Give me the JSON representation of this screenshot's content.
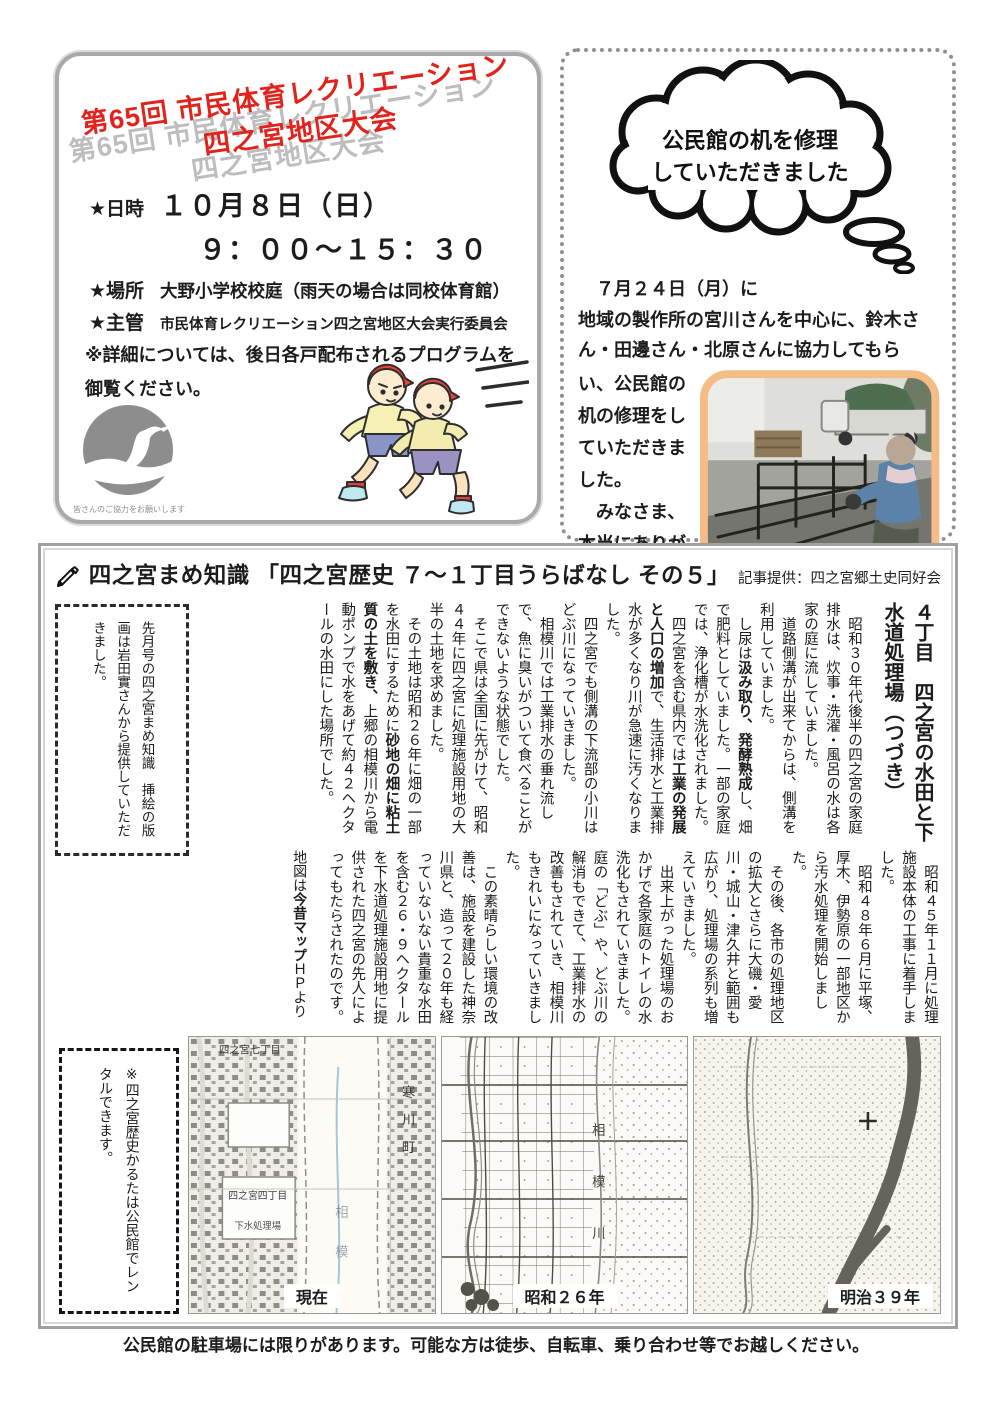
{
  "page": {
    "footer_notice": "公民館の駐車場には限りがあります。可能な方は徒歩、自転車、乗り合わせ等でお越しください。"
  },
  "event_box": {
    "title_line1": "第65回 市民体育レクリエーション",
    "title_line2": "四之宮地区大会",
    "datetime_label": "★日時",
    "date_value": "１０月８日（日）",
    "time_value": "９：００～１５：３０",
    "place_label": "★場所",
    "place_value": "大野小学校校庭（雨天の場合は同校体育館）",
    "organizer_label": "★主管",
    "organizer_value": "市民体育レクリエーション四之宮地区大会実行委員会",
    "note": "※詳細については、後日各戸配布されるプログラムを御覧ください。",
    "logo_caption": "皆さんのご協力をお願いします"
  },
  "repair_box": {
    "bubble_line1": "公民館の机を修理",
    "bubble_line2": "していただきました",
    "body_line1": "　７月２４日（月）に",
    "body_line2": "地域の製作所の宮川さんを中心に、鈴木さん・田邊さん・北原さんに協力してもら",
    "body_cont": "い、公民館の机の修理をしていただきました。",
    "body_thanks": "　みなさま、本当にありがとうございました。"
  },
  "article": {
    "header_title": "四之宮まめ知識 「四之宮歴史 ７～１丁目うらばなし その５」",
    "header_credit": "記事提供：四之宮郷土史同好会",
    "side_note": "先月号の四之宮まめ知識　挿絵の版画は岩田實さんから提供していただきました。",
    "heading": "４丁目　四之宮の水田と下水道処理場（つづき）",
    "upper_paragraphs": [
      "　昭和３０年代後半の四之宮の家庭排水は、炊事・洗濯・風呂の水は各家の庭に流していました。",
      "　道路側溝が出来てからは、側溝を利用していました。",
      "　し尿は汲み取り、発酵熟成し、畑で肥料としていました。一部の家庭では、浄化槽が水洗化されました。",
      "　四之宮を含む県内では工業の発展と人口の増加で、生活排水と工業排水が多くなり川が急速に汚くなりました。",
      "　四之宮でも側溝の下流部の小川はどぶ川になっていきました。",
      "　相模川では工業排水の垂れ流しで、魚に臭いがついて食べることができないような状態でした。",
      "　そこで県は全国に先がけて、昭和４４年に四之宮に処理施設用地の大半の土地を求めました。",
      "　その土地は昭和２６年に畑の一部を水田にするために砂地の畑に粘土質の土を敷き、上郷の相模川から電動ポンプで水をあげて約４２ヘクタールの水田にした場所でした。"
    ],
    "lower_paragraphs": [
      "　昭和４５年１１月に処理施設本体の工事に着手しました。",
      "　昭和４８年６月に平塚、厚木、伊勢原の一部地区から汚水処理を開始しました。",
      "　その後、各市の処理地区の拡大とさらに大磯・愛川・城山・津久井と範囲も広がり、処理場の系列も増えていきました。",
      "　出来上がった処理場のおかげで各家庭のトイレの水洗化もされていきました。庭の「どぶ」や、どぶ川の解消もできて、工業排水の改善もされていき、相模川もきれいになっていきました。",
      "　この素晴らしい環境の改善は、施設を建設した神奈川県と、造って２０年も経っていないない貴重な水田を含む２６・９ヘクタールを下水道処理施設用地に提供された四之宮の先人によってもたらされたのです。"
    ],
    "map_credit": "地図は今昔マップＨＰより",
    "rental_note": "※四之宮歴史かるたは公民館でレンタルできます。",
    "emphasized_terms": [
      "汲み取り、発酵熟成",
      "工業の発展と人口の増加",
      "砂地の畑に粘土質の土を敷き、",
      "今昔マップ"
    ],
    "maps": [
      {
        "caption": "現在",
        "labels": {
          "top": "四之宮七丁目",
          "town": "寒川町",
          "district": "四之宮四丁目",
          "plant": "下水処理場",
          "river": "相模"
        }
      },
      {
        "caption": "昭和２６年",
        "labels": {
          "river": "相模川"
        }
      },
      {
        "caption": "明治３９年",
        "labels": {}
      }
    ]
  }
}
